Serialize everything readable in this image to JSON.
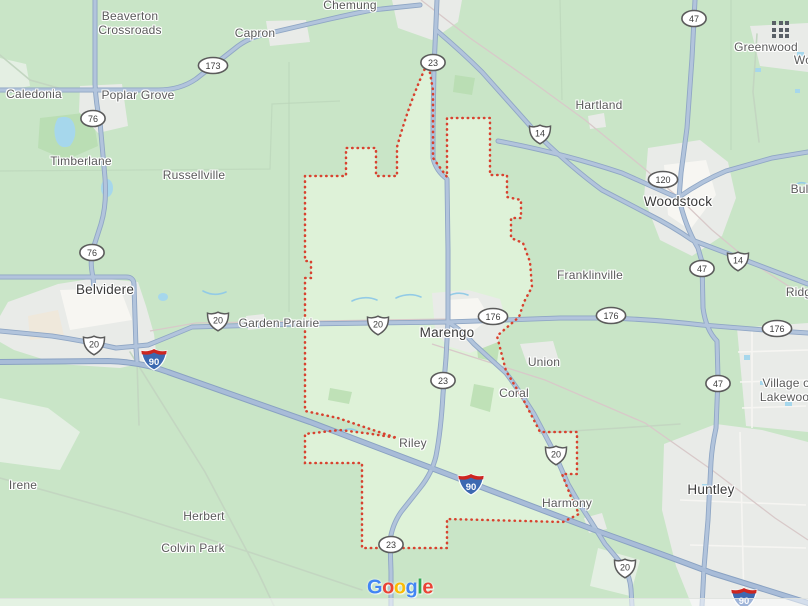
{
  "map": {
    "title": "Google Maps area view of Marengo, Illinois and surroundings",
    "attribution_logo": "Google",
    "logo_letters": [
      {
        "ch": "G",
        "color": "#4285F4"
      },
      {
        "ch": "o",
        "color": "#EA4335"
      },
      {
        "ch": "o",
        "color": "#FBBC05"
      },
      {
        "ch": "g",
        "color": "#4285F4"
      },
      {
        "ch": "l",
        "color": "#34A853"
      },
      {
        "ch": "e",
        "color": "#EA4335"
      }
    ]
  },
  "colors": {
    "land": "#c9e5c7",
    "city_boundary_fill": "#def2d8",
    "city_boundary_stroke": "#d8422f",
    "road_fill": "#b2c4dc",
    "road_casing": "#90a7c5",
    "urban": "#e9ebe8",
    "water": "#a6d7ec",
    "interstate_shield_blue": "#3d69b1",
    "interstate_shield_red": "#cd2620",
    "apps_grid_icon": "#596066"
  },
  "labels": [
    {
      "id": "beaverton-crossroads",
      "text": "Beaverton\nCrossroads",
      "x": 130,
      "y": 24,
      "tier": "minor"
    },
    {
      "id": "capron",
      "text": "Capron",
      "x": 255,
      "y": 34,
      "tier": "minor"
    },
    {
      "id": "chemung",
      "text": "Chemung",
      "x": 350,
      "y": 6,
      "tier": "minor"
    },
    {
      "id": "caledonia",
      "text": "Caledonia",
      "x": 34,
      "y": 95,
      "tier": "minor"
    },
    {
      "id": "poplar-grove",
      "text": "Poplar Grove",
      "x": 138,
      "y": 96,
      "tier": "minor"
    },
    {
      "id": "timberlane",
      "text": "Timberlane",
      "x": 81,
      "y": 162,
      "tier": "minor"
    },
    {
      "id": "russellville",
      "text": "Russellville",
      "x": 194,
      "y": 176,
      "tier": "minor"
    },
    {
      "id": "hartland",
      "text": "Hartland",
      "x": 599,
      "y": 106,
      "tier": "minor"
    },
    {
      "id": "greenwood",
      "text": "Greenwood",
      "x": 766,
      "y": 48,
      "tier": "minor"
    },
    {
      "id": "wonder-lake-cutoff",
      "text": "Wo",
      "x": 803,
      "y": 61,
      "tier": "minor"
    },
    {
      "id": "woodstock",
      "text": "Woodstock",
      "x": 678,
      "y": 202,
      "tier": "major"
    },
    {
      "id": "bull-valley-cutoff",
      "text": "Bull",
      "x": 801,
      "y": 190,
      "tier": "minor"
    },
    {
      "id": "belvidere",
      "text": "Belvidere",
      "x": 105,
      "y": 290,
      "tier": "major"
    },
    {
      "id": "garden-prairie",
      "text": "Garden Prairie",
      "x": 279,
      "y": 324,
      "tier": "minor"
    },
    {
      "id": "marengo",
      "text": "Marengo",
      "x": 447,
      "y": 333,
      "tier": "major"
    },
    {
      "id": "franklinville",
      "text": "Franklinville",
      "x": 590,
      "y": 276,
      "tier": "minor"
    },
    {
      "id": "ridgefield-cutoff",
      "text": "Ridge",
      "x": 802,
      "y": 293,
      "tier": "minor"
    },
    {
      "id": "union",
      "text": "Union",
      "x": 544,
      "y": 363,
      "tier": "minor"
    },
    {
      "id": "coral",
      "text": "Coral",
      "x": 514,
      "y": 394,
      "tier": "minor"
    },
    {
      "id": "village-of-lakewood",
      "text": "Village of\nLakewood",
      "x": 788,
      "y": 391,
      "tier": "minor"
    },
    {
      "id": "riley",
      "text": "Riley",
      "x": 413,
      "y": 444,
      "tier": "minor"
    },
    {
      "id": "harmony",
      "text": "Harmony",
      "x": 567,
      "y": 504,
      "tier": "minor"
    },
    {
      "id": "huntley",
      "text": "Huntley",
      "x": 711,
      "y": 490,
      "tier": "major"
    },
    {
      "id": "irene",
      "text": "Irene",
      "x": 23,
      "y": 486,
      "tier": "minor"
    },
    {
      "id": "herbert",
      "text": "Herbert",
      "x": 204,
      "y": 517,
      "tier": "minor"
    },
    {
      "id": "colvin-park",
      "text": "Colvin Park",
      "x": 193,
      "y": 549,
      "tier": "minor"
    }
  ],
  "route_shields": [
    {
      "type": "il",
      "num": "173",
      "x": 213,
      "y": 68
    },
    {
      "type": "il",
      "num": "76",
      "x": 93,
      "y": 121
    },
    {
      "type": "il",
      "num": "76",
      "x": 92,
      "y": 255
    },
    {
      "type": "il",
      "num": "23",
      "x": 433,
      "y": 65
    },
    {
      "type": "il",
      "num": "23",
      "x": 443,
      "y": 383
    },
    {
      "type": "il",
      "num": "23",
      "x": 391,
      "y": 547
    },
    {
      "type": "il",
      "num": "120",
      "x": 663,
      "y": 182
    },
    {
      "type": "il",
      "num": "47",
      "x": 694,
      "y": 21
    },
    {
      "type": "il",
      "num": "47",
      "x": 702,
      "y": 271
    },
    {
      "type": "il",
      "num": "47",
      "x": 718,
      "y": 386
    },
    {
      "type": "il",
      "num": "176",
      "x": 493,
      "y": 319
    },
    {
      "type": "il",
      "num": "176",
      "x": 611,
      "y": 318
    },
    {
      "type": "il",
      "num": "176",
      "x": 777,
      "y": 331
    },
    {
      "type": "us",
      "num": "14",
      "x": 540,
      "y": 137
    },
    {
      "type": "us",
      "num": "14",
      "x": 738,
      "y": 264
    },
    {
      "type": "us",
      "num": "20",
      "x": 94,
      "y": 348
    },
    {
      "type": "us",
      "num": "20",
      "x": 218,
      "y": 324
    },
    {
      "type": "us",
      "num": "20",
      "x": 378,
      "y": 328
    },
    {
      "type": "us",
      "num": "20",
      "x": 556,
      "y": 458
    },
    {
      "type": "us",
      "num": "20",
      "x": 625,
      "y": 571
    },
    {
      "type": "interstate",
      "num": "90",
      "x": 154,
      "y": 362
    },
    {
      "type": "interstate",
      "num": "90",
      "x": 471,
      "y": 487
    },
    {
      "type": "interstate",
      "num": "90",
      "x": 744,
      "y": 601
    }
  ]
}
